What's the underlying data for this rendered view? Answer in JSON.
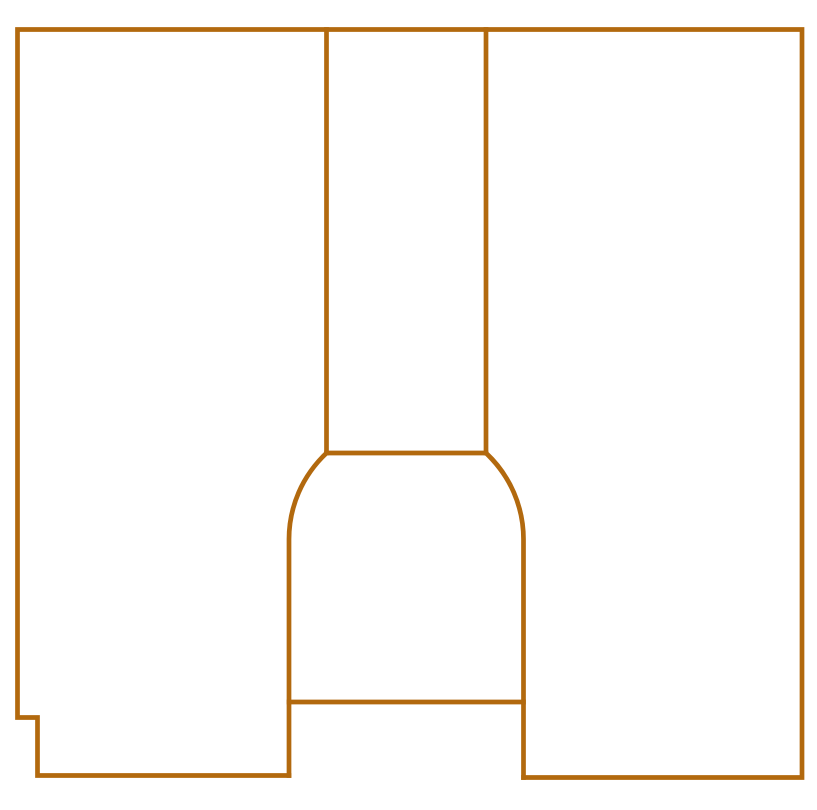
{
  "diagram": {
    "name": "keyhole-slot-cross-section",
    "canvas": {
      "width": 817,
      "height": 810,
      "background_color": "#FFFFFF"
    },
    "style": {
      "stroke_color": "#B2690E",
      "stroke_width": 4.7,
      "fill": "none",
      "linecap": "square",
      "linejoin": "miter"
    },
    "shapes": [
      {
        "name": "outer-shell-outline",
        "path": "M 289 775.5 L 37.5 775.5 L 37.5 717.5 L 17.5 717.5 L 17.5 29.5 L 802 29.5 L 802 777.5 L 523.5 777.5"
      },
      {
        "name": "slot-left-wall",
        "path": "M 326.5 29.5 L 326.5 453"
      },
      {
        "name": "slot-right-wall",
        "path": "M 486 29.5 L 486 453"
      },
      {
        "name": "slot-shoulder-line",
        "path": "M 326.5 453 L 486 453"
      },
      {
        "name": "bulb-left-side",
        "path": "M 326.5 453 A 118 118 0 0 0 289 540 L 289 775.5"
      },
      {
        "name": "bulb-right-side",
        "path": "M 486 453 A 118 118 0 0 1 523.5 540 L 523.5 777.5"
      },
      {
        "name": "bulb-crossbar-line",
        "path": "M 289 702 L 523.5 702"
      }
    ]
  }
}
